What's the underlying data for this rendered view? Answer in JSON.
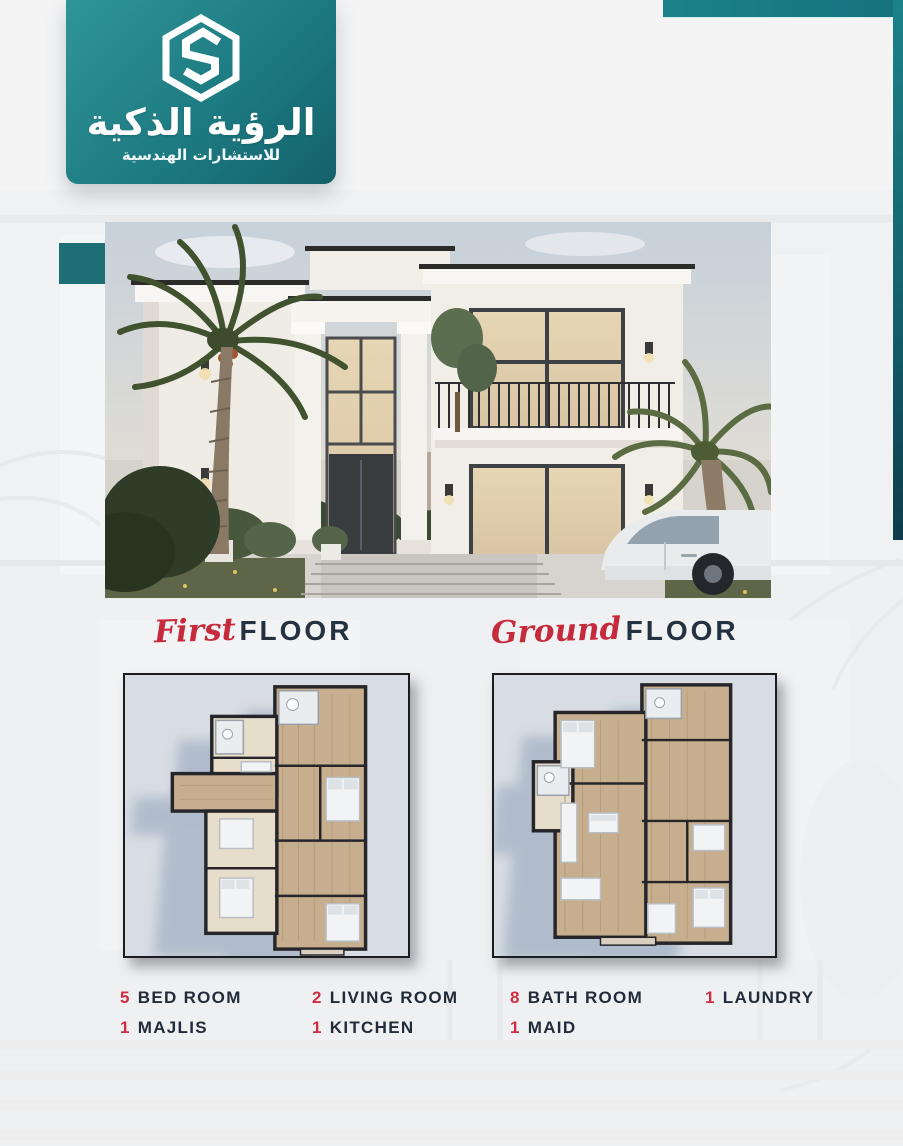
{
  "brand": {
    "logo_icon": "hexagon-s-logo",
    "name_ar": "الرؤية الذكية",
    "tagline_ar": "للاستشارات الهندسية"
  },
  "colors": {
    "teal": "#1d7b82",
    "teal_dark": "#0e3c4a",
    "red_accent": "#c62b3d",
    "navy_text": "#212b3a",
    "page_bg": "#f4f4f5",
    "plan_panel_bg": "#d8dde3"
  },
  "floor_sections": {
    "first": {
      "script": "First",
      "word": "FLOOR"
    },
    "ground": {
      "script": "Ground",
      "word": "FLOOR"
    }
  },
  "stats": [
    {
      "count": "5",
      "label": "BED ROOM"
    },
    {
      "count": "2",
      "label": "LIVING ROOM"
    },
    {
      "count": "8",
      "label": "BATH ROOM"
    },
    {
      "count": "1",
      "label": "LAUNDRY"
    },
    {
      "count": "1",
      "label": "MAJLIS"
    },
    {
      "count": "1",
      "label": "KITCHEN"
    },
    {
      "count": "1",
      "label": "MAID"
    }
  ]
}
